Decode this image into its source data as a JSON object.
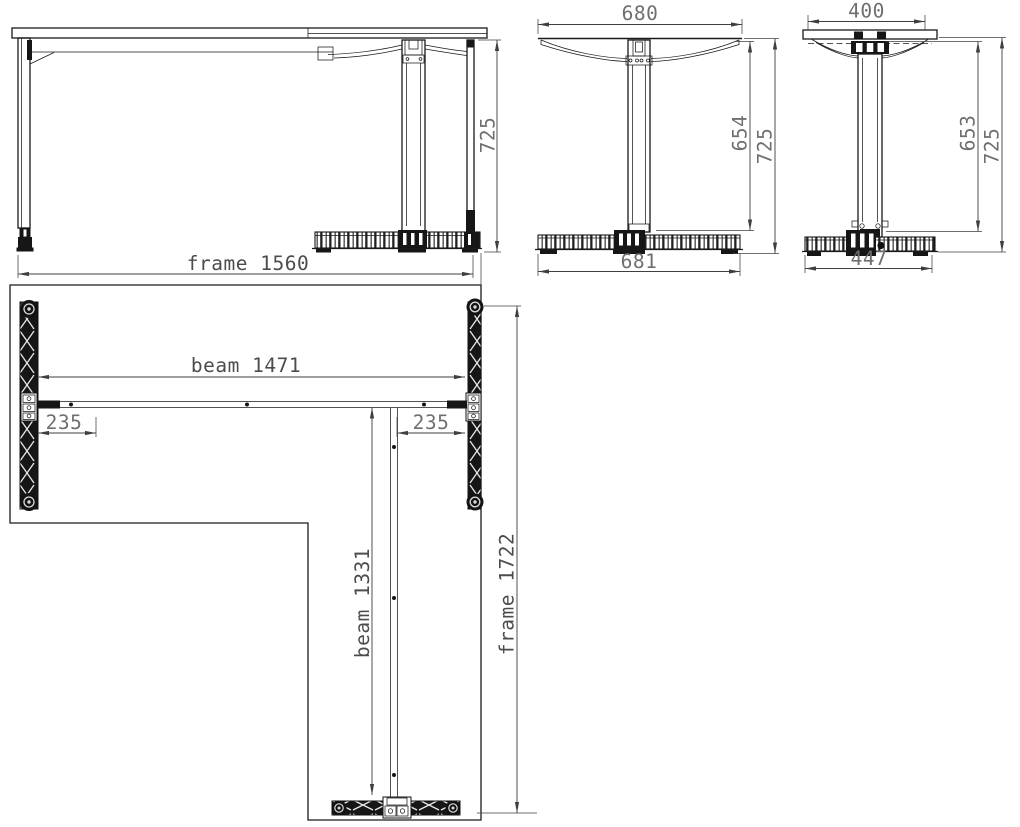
{
  "page": {
    "background": "#ffffff"
  },
  "drawing": {
    "type": "technical-orthographic-drawing",
    "subject": "L-shaped desk frame with T-legs: front view, two side views and plan view",
    "units": "mm",
    "colors": {
      "geometry_line": "#1a1a1a",
      "dimension_line": "#3f3f3f",
      "dimension_text": "#6f6f6f",
      "label_text": "#4c4c4c",
      "background": "#ffffff"
    },
    "front_view": {
      "dim_height": "725"
    },
    "side_view_long": {
      "dim_top_width": "680",
      "dim_column_height": "654",
      "dim_total_height": "725",
      "dim_foot_length": "681"
    },
    "side_view_short": {
      "dim_top_width": "400",
      "dim_column_height": "653",
      "dim_total_height": "725",
      "dim_foot_length": "447"
    },
    "plan_view": {
      "dim_frame_width": "frame 1560",
      "dim_beam_length": "beam 1471",
      "dim_left_offset": "235",
      "dim_right_offset": "235",
      "dim_return_beam_length": "beam 1331",
      "dim_frame_depth": "frame 1722"
    }
  }
}
